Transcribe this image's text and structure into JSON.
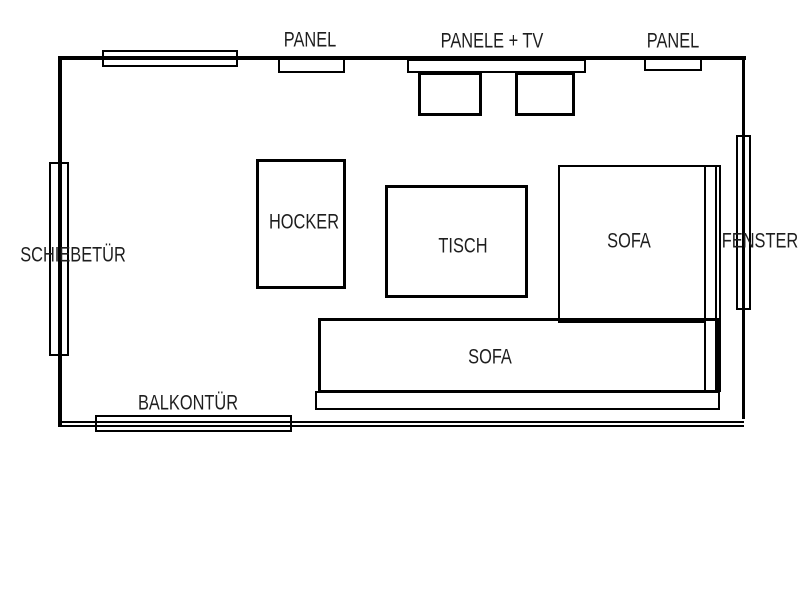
{
  "floorplan": {
    "background_color": "#ffffff",
    "line_color": "#000000",
    "text_color": "#1e1e1e",
    "wall_panels": {
      "panel_left_label": "PANEL",
      "panele_tv_label": "PANELE + TV",
      "panel_right_label": "PANEL"
    },
    "openings": {
      "sliding_door_label": "SCHIEBETÜR",
      "window_label": "FENSTER",
      "balcony_door_label": "BALKONTÜR"
    },
    "furniture": {
      "stool_label": "HOCKER",
      "table_label": "TISCH",
      "sofa_right_label": "SOFA",
      "sofa_bottom_label": "SOFA"
    }
  }
}
